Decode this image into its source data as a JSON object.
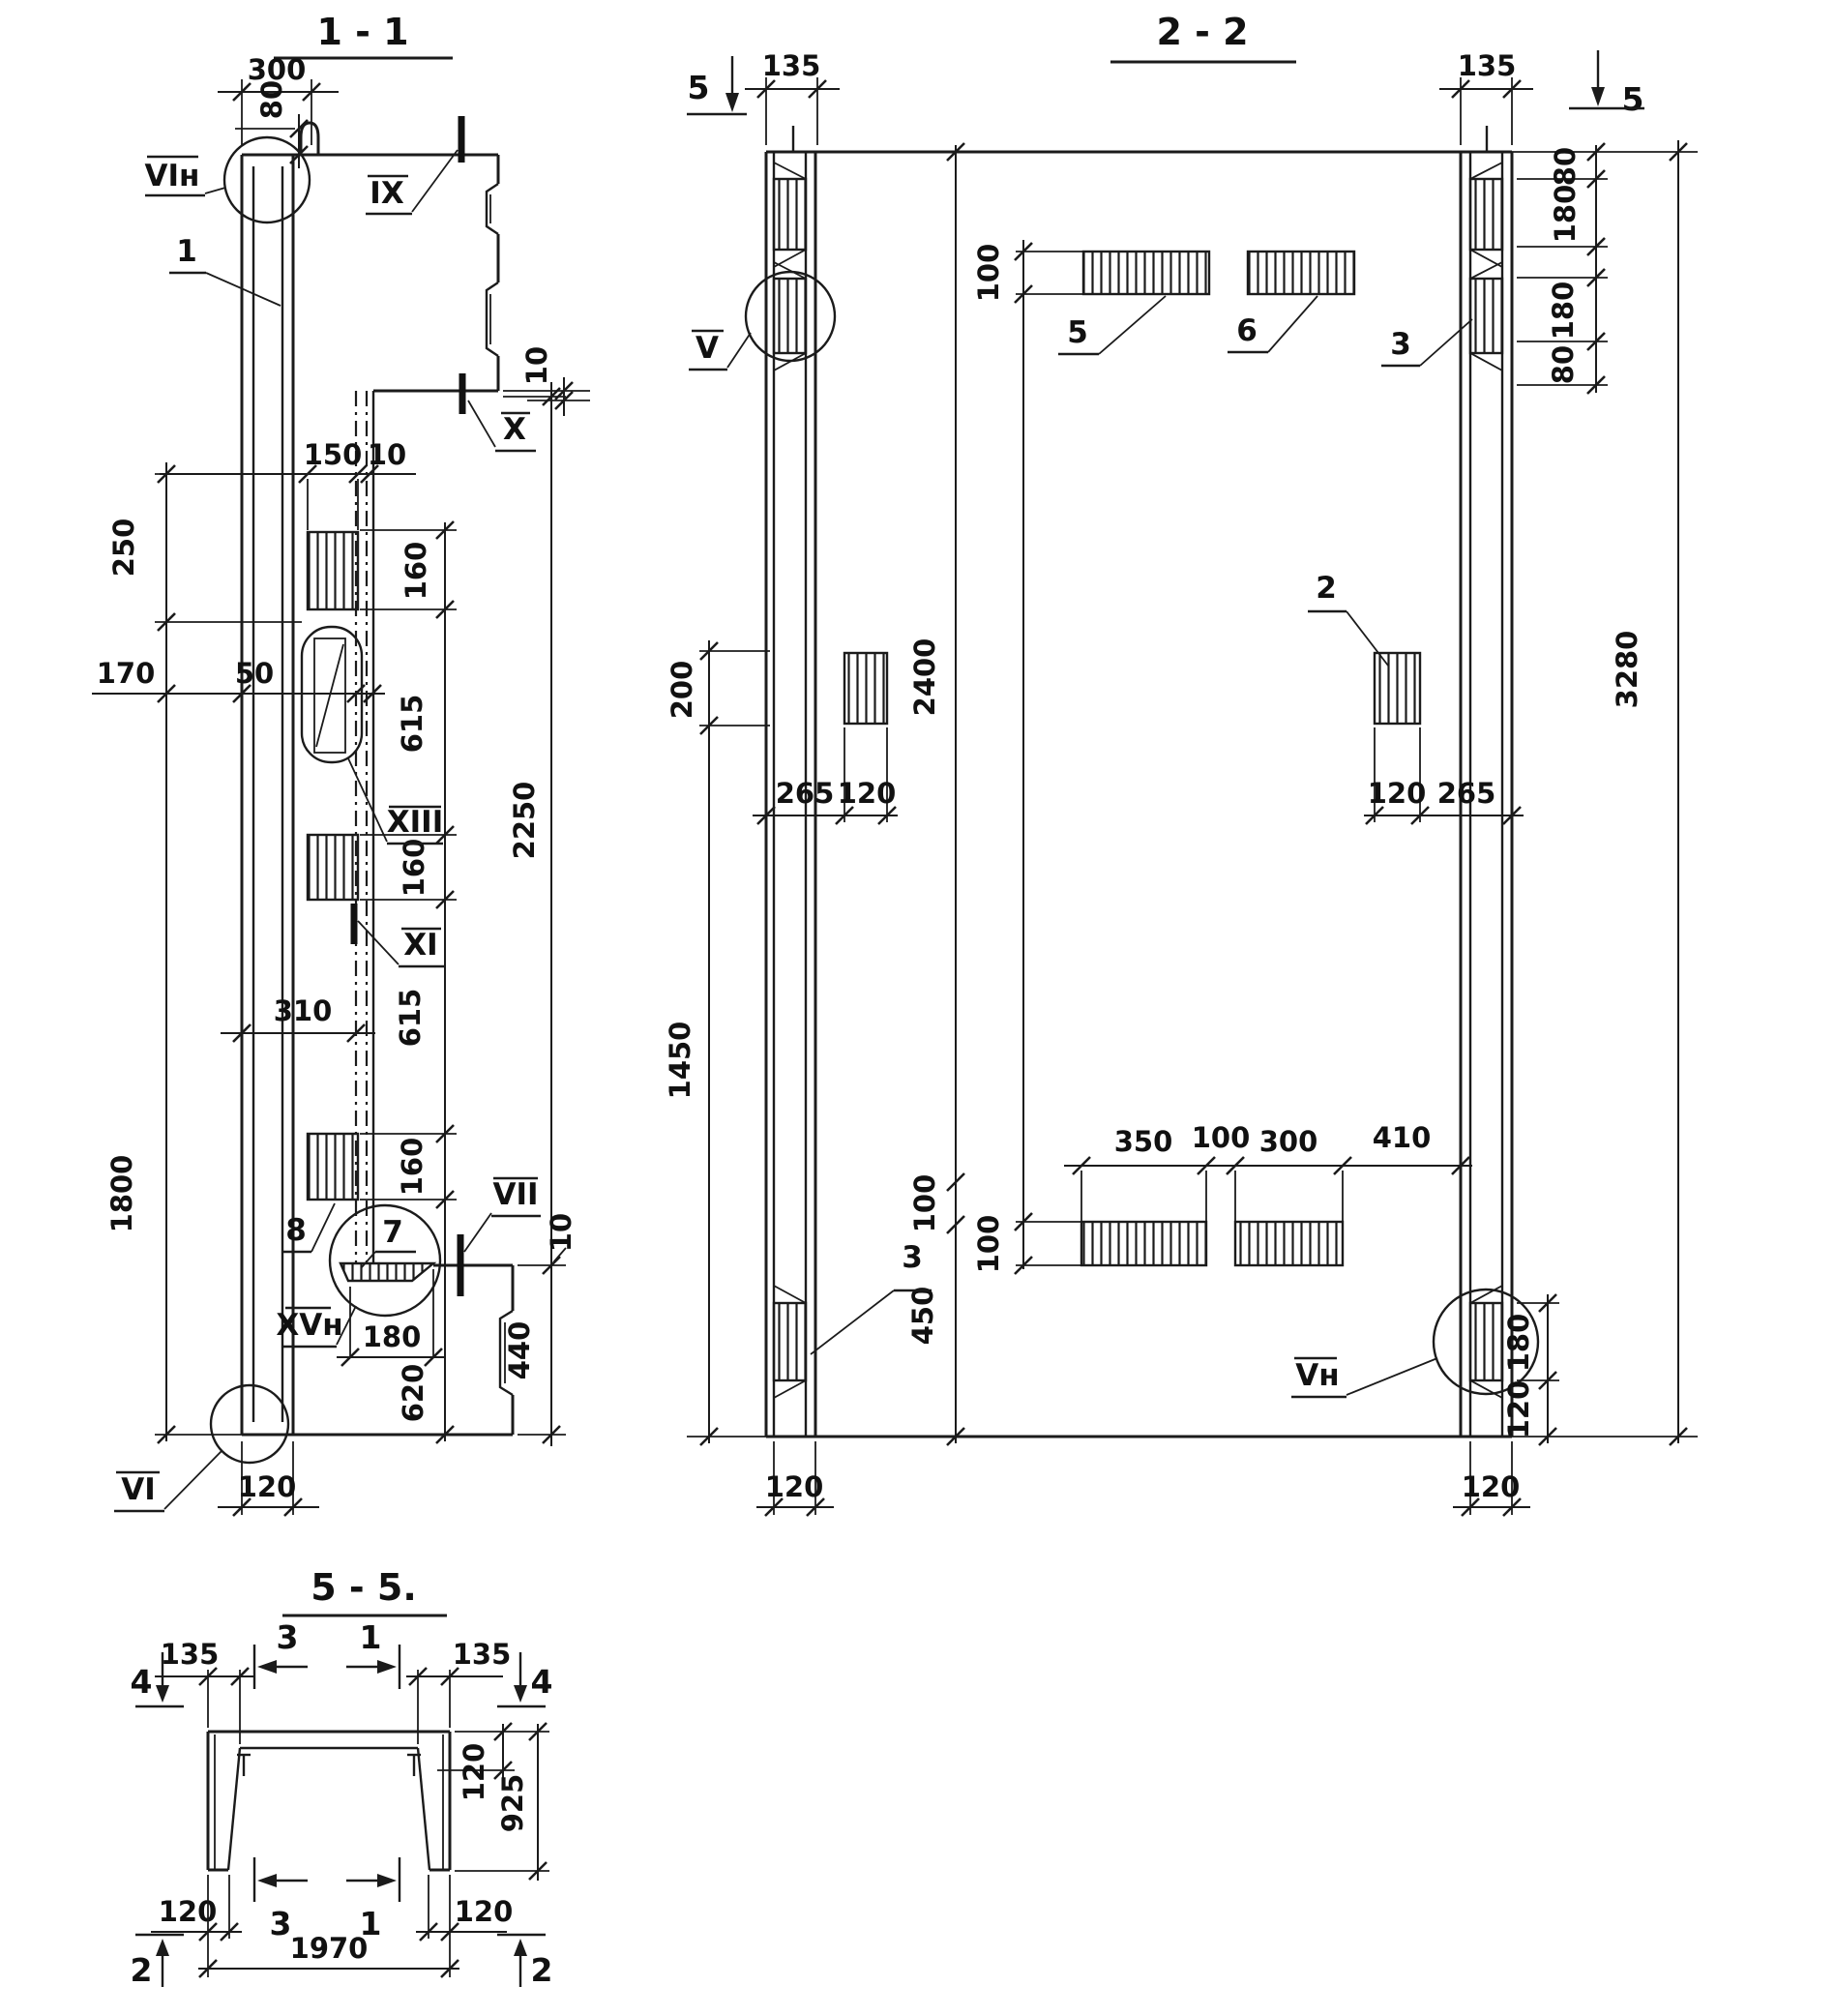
{
  "s11": {
    "title": "1 - 1",
    "d300": "300",
    "d80": "80",
    "d10_top": "10",
    "d150": "150",
    "d10_mid": "10",
    "d160_1": "160",
    "d615_1": "615",
    "d160_2": "160",
    "d615_2": "615",
    "d160_3": "160",
    "d2250": "2250",
    "d250": "250",
    "d170": "170",
    "d50": "50",
    "d310": "310",
    "d1800": "1800",
    "d10_bot": "10",
    "d180": "180",
    "d620": "620",
    "d440": "440",
    "d120": "120",
    "l_vin": "VIн",
    "l_1": "1",
    "l_ix": "IX",
    "l_x": "X",
    "l_xiii": "XIII",
    "l_xi": "XI",
    "l_vii": "VII",
    "l_xvn": "XVн",
    "l_vi": "VI",
    "l_7": "7",
    "l_8": "8"
  },
  "s22": {
    "title": "2 - 2",
    "m5_left": "5",
    "m5_right": "5",
    "d135_l": "135",
    "d135_r": "135",
    "d80_1": "80",
    "d180_1": "180",
    "d180_2": "180",
    "d80_2": "80",
    "d100_top": "100",
    "d200": "200",
    "d265_l": "265",
    "d120_lmid": "120",
    "d120_rmid": "120",
    "d265_r": "265",
    "d2400": "2400",
    "d3280": "3280",
    "d1450": "1450",
    "d350": "350",
    "d100_gap": "100",
    "d300": "300",
    "d410": "410",
    "d100_bot": "100",
    "d450": "450",
    "d120_lb": "120",
    "d120_rb": "120",
    "d180_rb": "180",
    "d120_rb2": "120",
    "l_v": "V",
    "l_vn": "Vн",
    "l_2": "2",
    "l_3t": "3",
    "l_5": "5",
    "l_6": "6",
    "l_3b": "3"
  },
  "s55": {
    "title": "5 - 5.",
    "m3_top": "3",
    "m1_top": "1",
    "m4_l": "4",
    "m4_r": "4",
    "m3_bot": "3",
    "m1_bot": "1",
    "m2_l": "2",
    "m2_r": "2",
    "d135_l": "135",
    "d135_r": "135",
    "d120_fl": "120",
    "d925": "925",
    "d120_bl": "120",
    "d120_br": "120",
    "d1970": "1970"
  }
}
